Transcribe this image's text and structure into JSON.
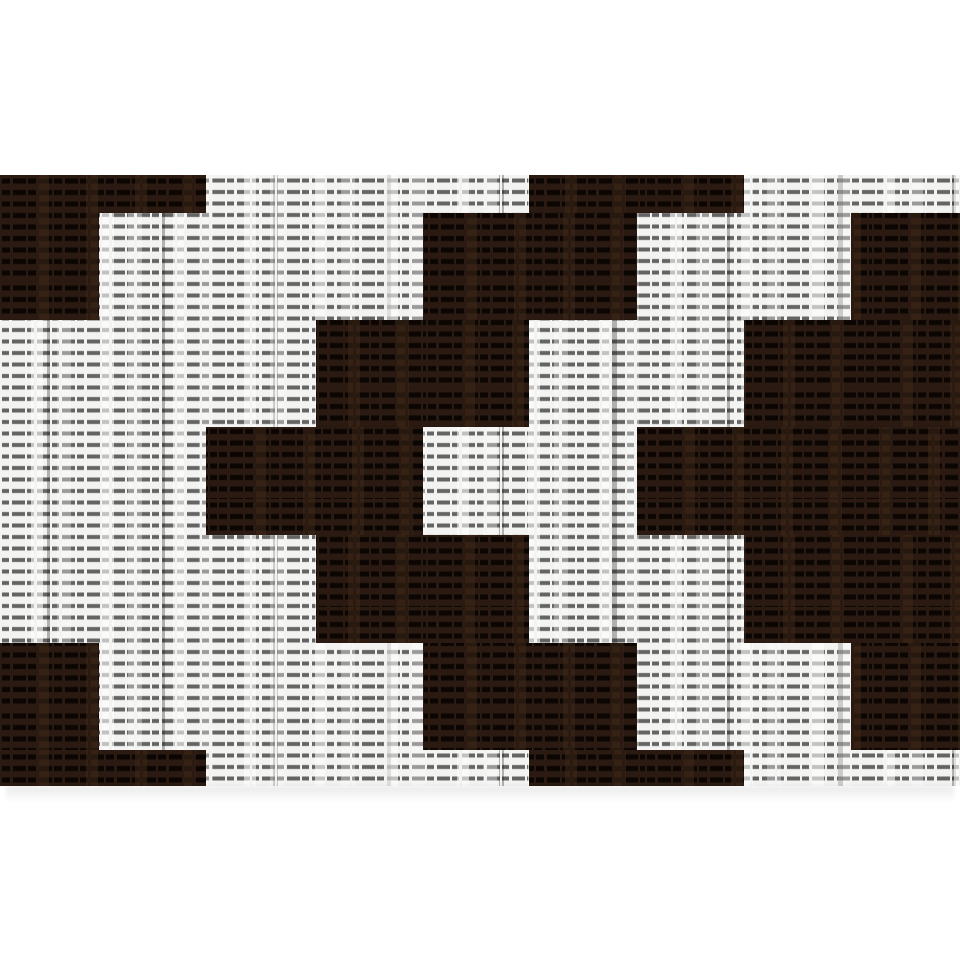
{
  "canvas": {
    "width": 960,
    "height": 960,
    "background": "#ffffff"
  },
  "photo": {
    "description": "Woven fabric swatch with stepped black-and-white geometric chevron pattern",
    "left": 0,
    "top": 175,
    "width": 960,
    "height": 611
  },
  "fabric": {
    "colors": {
      "white_base": "#f3f3f1",
      "white_dash": "rgba(45,45,45,0.72)",
      "dark_base": "#2a1a11",
      "dark_dash": "rgba(9,4,2,0.92)",
      "shadow": "rgba(0,0,0,0.085)"
    },
    "weave": {
      "row_pitch_px": 11.5,
      "dash_pitch_px": 13
    },
    "col_boundaries": [
      0,
      99,
      206,
      316,
      423,
      529,
      637,
      744,
      851,
      960
    ],
    "row_boundaries": [
      175,
      213,
      320,
      427,
      535,
      643,
      750,
      786
    ],
    "grid": [
      "DDWWWDDWW",
      "DWWWDDWWD",
      "WWWDDWWDD",
      "WWDDWWDDD",
      "WWWDDWWDD",
      "DWWWDDWWD",
      "DDWWWDDWW"
    ],
    "legend": {
      "D": "dark block",
      "W": "white block"
    }
  }
}
